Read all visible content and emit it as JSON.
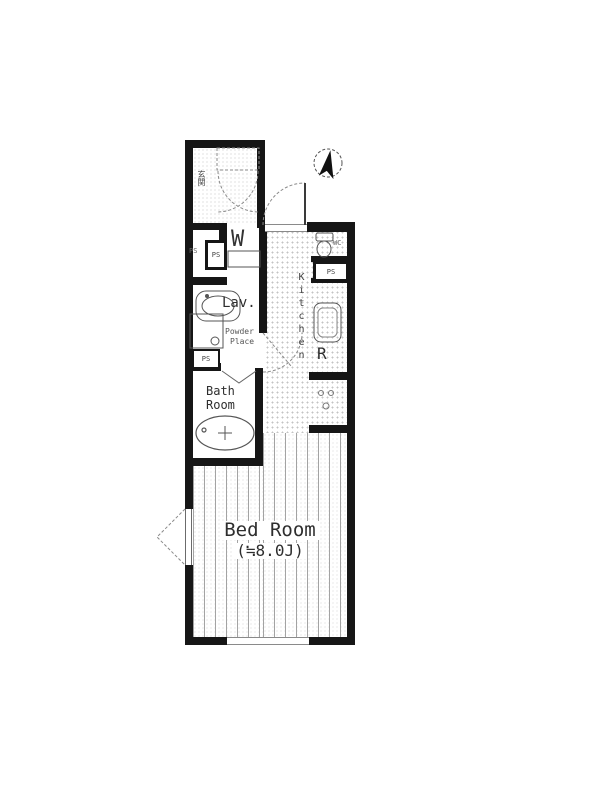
{
  "plan": {
    "labels": {
      "entrance": "玄関",
      "washer_niche": "W",
      "lavatory": "Lav.",
      "powder_line1": "Powder",
      "powder_line2": "Place",
      "bath_line1": "Bath",
      "bath_line2": "Room",
      "kitchen": "Kitchen",
      "fridge_space": "R",
      "wc": "WC",
      "bedroom_name": "Bed Room",
      "bedroom_size": "(≒8.0J)",
      "ps_meter_small": "PS",
      "ps_meter_upper": "PS",
      "ps_meter_lav": "PS",
      "ps_meter_kitchen": "PS"
    },
    "icons": {
      "compass": "north-arrow"
    },
    "colors": {
      "wall": "#161616",
      "fixture_line": "#555555",
      "dashed_line": "#8a8a8a",
      "floor_dot": "#c3c3c3",
      "floor_stripe": "#a3a3a3",
      "text": "#2e2e2e"
    }
  }
}
